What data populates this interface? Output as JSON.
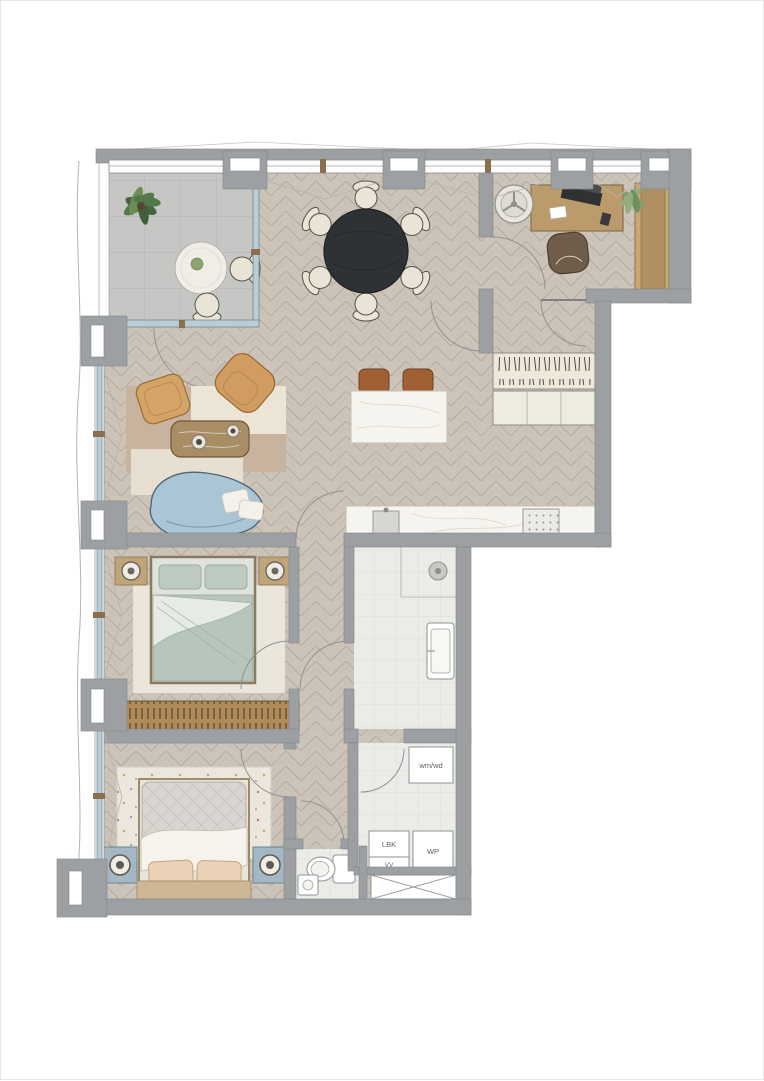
{
  "plan": {
    "utility_labels": {
      "washer_dryer": "wm/wd",
      "lbk": "LBK",
      "vv": "VV",
      "wp": "WP"
    }
  },
  "colors": {
    "wall": "#9da0a2",
    "floor_wood": "#ccc3b9",
    "balcony_tile": "#c6c7c4",
    "wet_room_tile": "#ebebe7",
    "marble": "#f6f4ef",
    "glass": "#b9cdd6",
    "sofa_blue": "#a9c5d6",
    "accent_orange": "#d09c62",
    "dining_table_black": "#2e3234",
    "bed_sage": "#b7c5bc",
    "nightstand_blue": "#a3b8c4",
    "wood": "#bb9a6c",
    "wardrobe_wood": "#b08a58",
    "chair_cream": "#eae4d6"
  }
}
